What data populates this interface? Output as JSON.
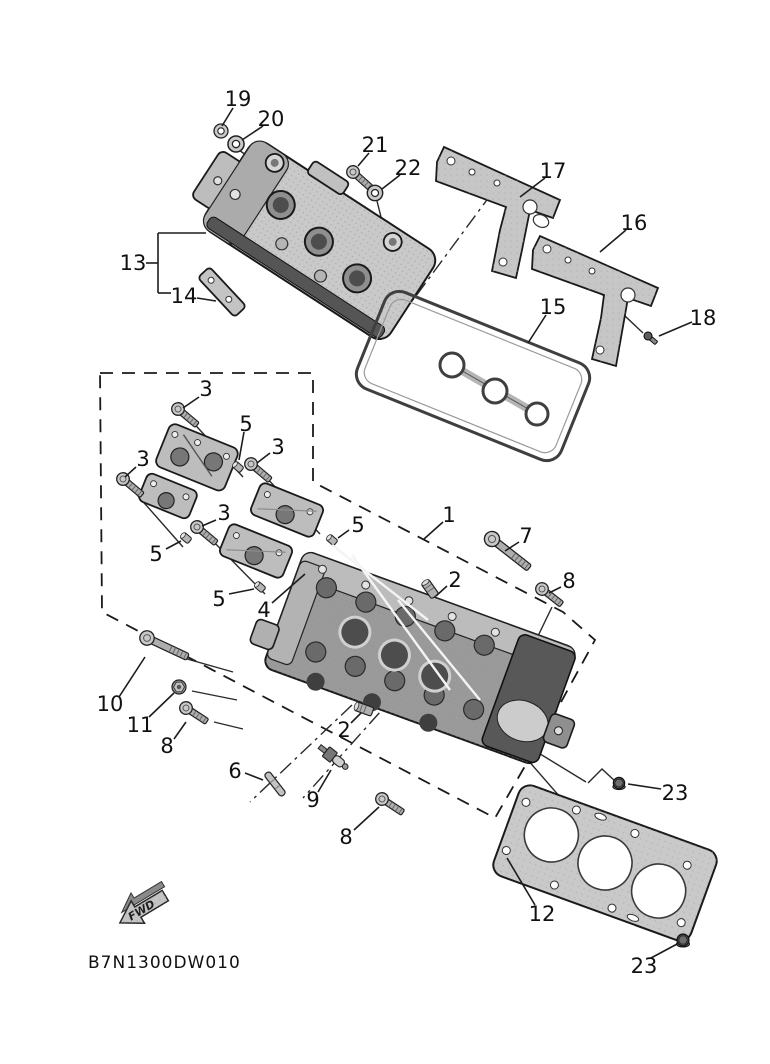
{
  "diagram": {
    "code": "B7N1300DW010",
    "fwd_label": "FWD",
    "colors": {
      "light": "#c9c9c9",
      "mid": "#9a9a9a",
      "dark": "#6a6a6a",
      "darker": "#3f3f3f",
      "outline": "#1a1a1a",
      "paper": "#ffffff"
    },
    "callouts": [
      {
        "label": "19",
        "x": 238,
        "y": 99,
        "lines": [
          [
            233,
            108,
            222,
            126
          ]
        ]
      },
      {
        "label": "20",
        "x": 271,
        "y": 119,
        "lines": [
          [
            263,
            126,
            242,
            140
          ]
        ]
      },
      {
        "label": "21",
        "x": 375,
        "y": 145,
        "lines": [
          [
            369,
            153,
            358,
            166
          ]
        ]
      },
      {
        "label": "22",
        "x": 408,
        "y": 168,
        "lines": [
          [
            400,
            175,
            382,
            189
          ]
        ]
      },
      {
        "label": "17",
        "x": 553,
        "y": 171,
        "lines": [
          [
            545,
            178,
            520,
            197
          ]
        ]
      },
      {
        "label": "16",
        "x": 634,
        "y": 223,
        "lines": [
          [
            626,
            230,
            600,
            252
          ]
        ]
      },
      {
        "label": "18",
        "x": 703,
        "y": 318,
        "lines": [
          [
            692,
            322,
            659,
            336
          ]
        ]
      },
      {
        "label": "15",
        "x": 553,
        "y": 307,
        "lines": [
          [
            546,
            315,
            528,
            343
          ]
        ]
      },
      {
        "label": "13",
        "x": 133,
        "y": 263,
        "lines": [
          [
            146,
            263,
            158,
            263
          ],
          [
            158,
            233,
            158,
            293
          ],
          [
            158,
            233,
            206,
            233
          ],
          [
            158,
            293,
            171,
            293
          ]
        ]
      },
      {
        "label": "14",
        "x": 184,
        "y": 296,
        "lines": [
          [
            197,
            298,
            216,
            301
          ]
        ]
      },
      {
        "label": "3",
        "x": 206,
        "y": 389,
        "lines": [
          [
            199,
            397,
            183,
            408
          ]
        ]
      },
      {
        "label": "5",
        "x": 246,
        "y": 424,
        "lines": [
          [
            244,
            432,
            239,
            460
          ]
        ]
      },
      {
        "label": "3",
        "x": 143,
        "y": 459,
        "lines": [
          [
            136,
            467,
            125,
            477
          ]
        ]
      },
      {
        "label": "3",
        "x": 278,
        "y": 447,
        "lines": [
          [
            270,
            453,
            257,
            463
          ]
        ]
      },
      {
        "label": "3",
        "x": 224,
        "y": 513,
        "lines": [
          [
            216,
            520,
            202,
            526
          ]
        ]
      },
      {
        "label": "5",
        "x": 156,
        "y": 554,
        "lines": [
          [
            166,
            549,
            181,
            541
          ]
        ]
      },
      {
        "label": "5",
        "x": 219,
        "y": 599,
        "lines": [
          [
            229,
            594,
            254,
            589
          ]
        ]
      },
      {
        "label": "5",
        "x": 358,
        "y": 525,
        "lines": [
          [
            349,
            530,
            338,
            538
          ]
        ]
      },
      {
        "label": "4",
        "x": 264,
        "y": 610,
        "lines": [
          [
            272,
            603,
            305,
            574
          ]
        ]
      },
      {
        "label": "1",
        "x": 449,
        "y": 515,
        "lines": [
          [
            443,
            522,
            424,
            539
          ]
        ]
      },
      {
        "label": "7",
        "x": 526,
        "y": 536,
        "lines": [
          [
            519,
            542,
            505,
            551
          ]
        ]
      },
      {
        "label": "2",
        "x": 455,
        "y": 580,
        "lines": [
          [
            447,
            586,
            436,
            596
          ]
        ]
      },
      {
        "label": "8",
        "x": 569,
        "y": 581,
        "lines": [
          [
            561,
            587,
            549,
            593
          ]
        ]
      },
      {
        "label": "10",
        "x": 110,
        "y": 704,
        "lines": [
          [
            119,
            697,
            145,
            657
          ]
        ]
      },
      {
        "label": "11",
        "x": 140,
        "y": 725,
        "lines": [
          [
            149,
            717,
            174,
            693
          ]
        ]
      },
      {
        "label": "8",
        "x": 167,
        "y": 746,
        "lines": [
          [
            174,
            739,
            186,
            722
          ]
        ]
      },
      {
        "label": "2",
        "x": 344,
        "y": 730,
        "lines": [
          [
            351,
            723,
            361,
            713
          ]
        ]
      },
      {
        "label": "6",
        "x": 235,
        "y": 771,
        "lines": [
          [
            245,
            773,
            263,
            780
          ]
        ]
      },
      {
        "label": "9",
        "x": 313,
        "y": 800,
        "lines": [
          [
            318,
            792,
            331,
            770
          ]
        ]
      },
      {
        "label": "8",
        "x": 346,
        "y": 837,
        "lines": [
          [
            354,
            830,
            379,
            807
          ]
        ]
      },
      {
        "label": "12",
        "x": 542,
        "y": 914,
        "lines": [
          [
            535,
            905,
            507,
            858
          ]
        ]
      },
      {
        "label": "23",
        "x": 675,
        "y": 793,
        "lines": [
          [
            661,
            789,
            628,
            784
          ]
        ]
      },
      {
        "label": "23",
        "x": 644,
        "y": 966,
        "lines": [
          [
            651,
            958,
            679,
            943
          ]
        ]
      }
    ]
  }
}
